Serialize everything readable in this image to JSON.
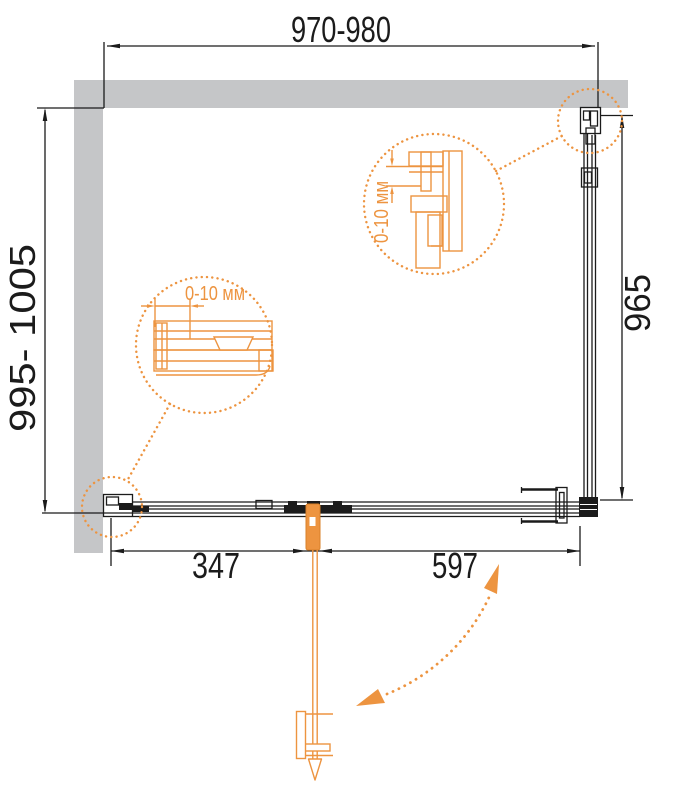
{
  "colors": {
    "accent": "#ED9440",
    "line": "#1b1b1b",
    "wall": "#c5c6c8"
  },
  "dimensions": {
    "top": "970-980",
    "left": "995- 1005",
    "right": "965",
    "bottom_left": "347",
    "bottom_right": "597"
  },
  "details": {
    "upper_adjustment": "0-10 мм",
    "lower_adjustment": "0-10 мм"
  }
}
